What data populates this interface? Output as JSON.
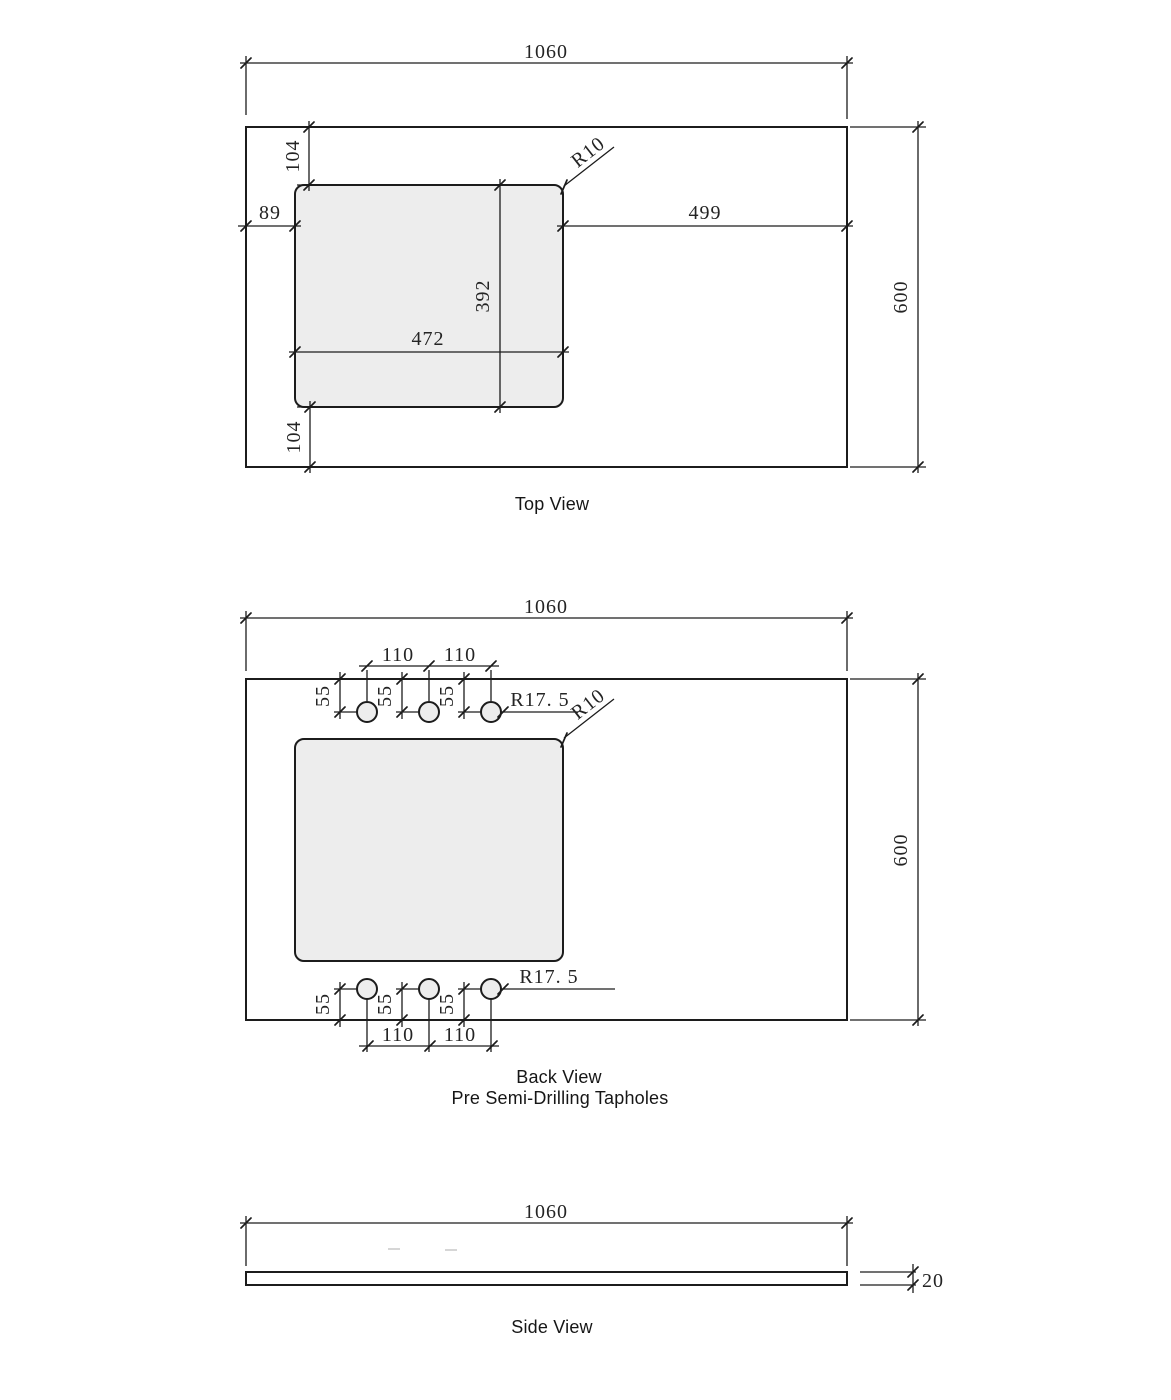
{
  "top_view": {
    "title": "Top View",
    "overall_width": "1060",
    "overall_depth": "600",
    "left_offset": "89",
    "top_offset": "104",
    "bottom_offset": "104",
    "cutout_width": "472",
    "cutout_depth": "392",
    "right_offset": "499",
    "corner_radius": "R10"
  },
  "back_view": {
    "title": "Back View",
    "subtitle": "Pre Semi-Drilling Tapholes",
    "overall_width": "1060",
    "overall_depth": "600",
    "hole_pitch": "110",
    "hole_offset": "55",
    "taphole_radius": "R17. 5",
    "corner_radius": "R10"
  },
  "side_view": {
    "title": "Side View",
    "overall_width": "1060",
    "thickness": "20"
  }
}
